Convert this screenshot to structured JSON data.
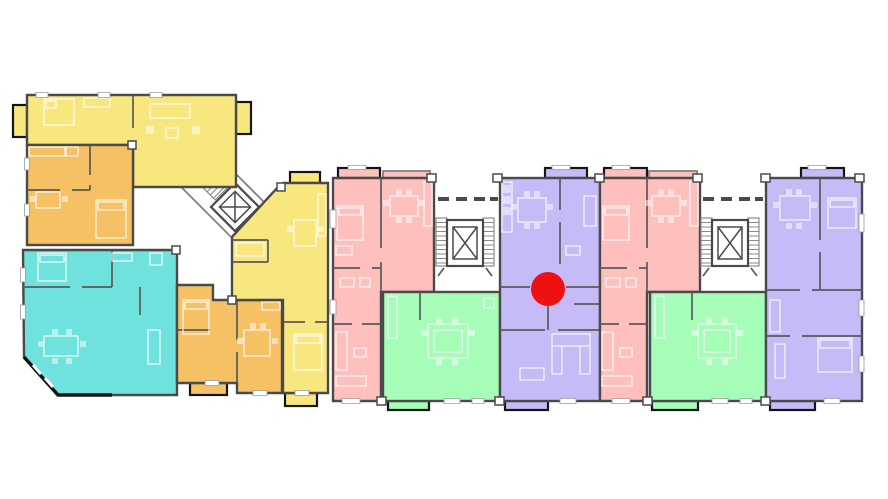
{
  "canvas": {
    "width": 888,
    "height": 499,
    "background": "#ffffff"
  },
  "colors": {
    "wall": "#4a4a4a",
    "wall_dark": "#151515",
    "wall_soft": "#8a8a8a",
    "furniture": "rgba(255,255,255,0.85)",
    "furniture_fill": "rgba(255,255,255,0.5)",
    "window": "#ffffff",
    "marker_red": "#ee1111"
  },
  "units": [
    {
      "id": "yellow-a",
      "wing": "left",
      "color": "#f8e77e"
    },
    {
      "id": "orange-1",
      "wing": "left",
      "color": "#f5c164"
    },
    {
      "id": "teal-1",
      "wing": "left",
      "color": "#6fe2de"
    },
    {
      "id": "orange-2",
      "wing": "left",
      "color": "#f5c164"
    },
    {
      "id": "yellow-b",
      "wing": "left",
      "color": "#f8e77e"
    },
    {
      "id": "pink-1",
      "wing": "right",
      "color": "#ffc0bd"
    },
    {
      "id": "green-1",
      "wing": "right",
      "color": "#a5fdb8"
    },
    {
      "id": "purple-mid",
      "wing": "right",
      "color": "#c6baf7"
    },
    {
      "id": "pink-2",
      "wing": "right",
      "color": "#ffc0bd"
    },
    {
      "id": "green-2",
      "wing": "right",
      "color": "#a5fdb8"
    },
    {
      "id": "purple-right",
      "wing": "right",
      "color": "#c6baf7"
    }
  ],
  "marker": {
    "color": "#ee1111",
    "cx": 548,
    "cy": 289,
    "r": 17
  },
  "icons": {
    "elevator": "elevator-shaft-x-icon",
    "stairs": "stair-flight-icon"
  }
}
